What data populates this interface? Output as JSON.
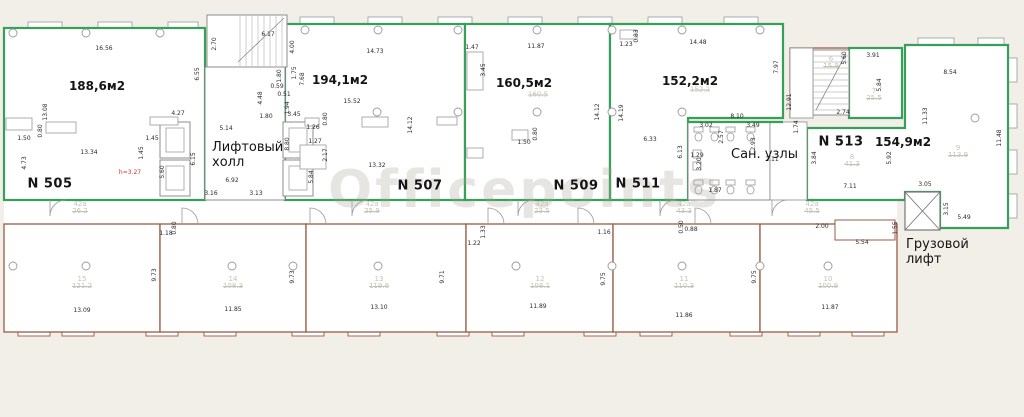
{
  "plan": {
    "watermark": "Officepoints",
    "colors": {
      "wall_green": "#36a05b",
      "wall_brown": "#9a5b45",
      "wall_gray": "#8c8c8c",
      "dim_text": "#2a2a2a",
      "ghost_text": "#c7c2b6",
      "red_dim": "#c0392b",
      "page_bg": "#f2efe8"
    },
    "rooms": [
      {
        "number": "N 505",
        "area": "188,6м2",
        "nx": 50,
        "ny": 184,
        "ax": 97,
        "ay": 86
      },
      {
        "number": "N 507",
        "area": "194,1м2",
        "nx": 420,
        "ny": 186,
        "ax": 340,
        "ay": 80
      },
      {
        "number": "N 509",
        "area": "160,5м2",
        "nx": 576,
        "ny": 186,
        "ax": 524,
        "ay": 83
      },
      {
        "number": "N 511",
        "area": "152,2м2",
        "nx": 638,
        "ny": 184,
        "ax": 690,
        "ay": 81
      },
      {
        "number": "N 513",
        "area": "154,9м2",
        "nx": 841,
        "ny": 142,
        "ax": 903,
        "ay": 142
      }
    ],
    "zones": [
      {
        "name": "lift-hall-label",
        "lines": [
          "Лифтовый",
          "холл"
        ],
        "x": 212,
        "y": 140
      },
      {
        "name": "san-units-label",
        "lines": [
          "Сан. узлы"
        ],
        "x": 731,
        "y": 147
      },
      {
        "name": "freight-lift-label",
        "lines": [
          "Грузовой",
          "лифт"
        ],
        "x": 906,
        "y": 237
      }
    ],
    "dimensions": [
      {
        "t": "16.56",
        "x": 104,
        "y": 49
      },
      {
        "t": "6.55",
        "x": 198,
        "y": 74,
        "v": 1
      },
      {
        "t": "13.08",
        "x": 46,
        "y": 112,
        "v": 1
      },
      {
        "t": "4.27",
        "x": 178,
        "y": 114
      },
      {
        "t": "1.50",
        "x": 24,
        "y": 139
      },
      {
        "t": "0.80",
        "x": 41,
        "y": 131,
        "v": 1
      },
      {
        "t": "13.34",
        "x": 89,
        "y": 153
      },
      {
        "t": "1.45",
        "x": 152,
        "y": 139
      },
      {
        "t": "1.45",
        "x": 142,
        "y": 153,
        "v": 1
      },
      {
        "t": "4.73",
        "x": 25,
        "y": 163,
        "v": 1
      },
      {
        "t": "5.60",
        "x": 163,
        "y": 172,
        "v": 1
      },
      {
        "t": "6.15",
        "x": 194,
        "y": 159,
        "v": 1
      },
      {
        "t": "h=3.27",
        "x": 130,
        "y": 173,
        "c": 1
      },
      {
        "t": "2.70",
        "x": 215,
        "y": 44,
        "v": 1
      },
      {
        "t": "6.17",
        "x": 268,
        "y": 35
      },
      {
        "t": "4.00",
        "x": 293,
        "y": 47,
        "v": 1
      },
      {
        "t": "5.14",
        "x": 226,
        "y": 129
      },
      {
        "t": "6.92",
        "x": 232,
        "y": 181
      },
      {
        "t": "3.16",
        "x": 211,
        "y": 194
      },
      {
        "t": "3.13",
        "x": 256,
        "y": 194
      },
      {
        "t": "8.80",
        "x": 288,
        "y": 144,
        "v": 1
      },
      {
        "t": "4.48",
        "x": 261,
        "y": 98,
        "v": 1
      },
      {
        "t": "1.80",
        "x": 266,
        "y": 117
      },
      {
        "t": "0.59",
        "x": 277,
        "y": 87
      },
      {
        "t": "0.51",
        "x": 284,
        "y": 95
      },
      {
        "t": "1.94",
        "x": 288,
        "y": 108,
        "v": 1
      },
      {
        "t": "1.80",
        "x": 280,
        "y": 76,
        "v": 1
      },
      {
        "t": "1.75",
        "x": 295,
        "y": 73,
        "v": 1
      },
      {
        "t": "7.68",
        "x": 303,
        "y": 79,
        "v": 1
      },
      {
        "t": "14.73",
        "x": 375,
        "y": 52
      },
      {
        "t": "15.52",
        "x": 352,
        "y": 102
      },
      {
        "t": "14.12",
        "x": 411,
        "y": 125,
        "v": 1
      },
      {
        "t": "13.32",
        "x": 377,
        "y": 166
      },
      {
        "t": "3.45",
        "x": 294,
        "y": 115
      },
      {
        "t": "1.26",
        "x": 313,
        "y": 128
      },
      {
        "t": "1.27",
        "x": 315,
        "y": 142
      },
      {
        "t": "2.17",
        "x": 326,
        "y": 155,
        "v": 1
      },
      {
        "t": "5.84",
        "x": 312,
        "y": 177,
        "v": 1
      },
      {
        "t": "0.80",
        "x": 326,
        "y": 119,
        "v": 1
      },
      {
        "t": "1.47",
        "x": 472,
        "y": 48
      },
      {
        "t": "11.87",
        "x": 536,
        "y": 47
      },
      {
        "t": "3.45",
        "x": 484,
        "y": 70,
        "v": 1
      },
      {
        "t": "1.50",
        "x": 524,
        "y": 143
      },
      {
        "t": "0.80",
        "x": 536,
        "y": 134,
        "v": 1
      },
      {
        "t": "1.23",
        "x": 626,
        "y": 45
      },
      {
        "t": "0.83",
        "x": 637,
        "y": 36,
        "v": 1
      },
      {
        "t": "14.48",
        "x": 698,
        "y": 43
      },
      {
        "t": "7.97",
        "x": 777,
        "y": 67,
        "v": 1
      },
      {
        "t": "12.91",
        "x": 790,
        "y": 102,
        "v": 1
      },
      {
        "t": "14.12",
        "x": 598,
        "y": 112,
        "v": 1
      },
      {
        "t": "14.19",
        "x": 622,
        "y": 113,
        "v": 1
      },
      {
        "t": "6.33",
        "x": 650,
        "y": 140
      },
      {
        "t": "8.10",
        "x": 737,
        "y": 117
      },
      {
        "t": "3.02",
        "x": 706,
        "y": 126
      },
      {
        "t": "3.49",
        "x": 753,
        "y": 126
      },
      {
        "t": "2.57",
        "x": 722,
        "y": 137,
        "v": 1
      },
      {
        "t": "2.93",
        "x": 754,
        "y": 144,
        "v": 1
      },
      {
        "t": "2.11",
        "x": 772,
        "y": 160
      },
      {
        "t": "6.13",
        "x": 681,
        "y": 152,
        "v": 1
      },
      {
        "t": "3.20",
        "x": 700,
        "y": 164,
        "v": 1
      },
      {
        "t": "1.29",
        "x": 697,
        "y": 156
      },
      {
        "t": "1.87",
        "x": 715,
        "y": 191
      },
      {
        "t": "1.74",
        "x": 797,
        "y": 127,
        "v": 1
      },
      {
        "t": "3.84",
        "x": 815,
        "y": 158,
        "v": 1
      },
      {
        "t": "2.74",
        "x": 843,
        "y": 113
      },
      {
        "t": "5.60",
        "x": 845,
        "y": 58,
        "v": 1
      },
      {
        "t": "3.91",
        "x": 873,
        "y": 56
      },
      {
        "t": "5.84",
        "x": 880,
        "y": 85,
        "v": 1
      },
      {
        "t": "8.54",
        "x": 950,
        "y": 73
      },
      {
        "t": "11.33",
        "x": 926,
        "y": 116,
        "v": 1
      },
      {
        "t": "11.48",
        "x": 1000,
        "y": 138,
        "v": 1
      },
      {
        "t": "3.05",
        "x": 925,
        "y": 185
      },
      {
        "t": "3.15",
        "x": 947,
        "y": 209,
        "v": 1
      },
      {
        "t": "5.49",
        "x": 964,
        "y": 218
      },
      {
        "t": "7.11",
        "x": 850,
        "y": 187
      },
      {
        "t": "5.92",
        "x": 890,
        "y": 158,
        "v": 1
      },
      {
        "t": "2.00",
        "x": 822,
        "y": 227
      },
      {
        "t": "5.54",
        "x": 862,
        "y": 243
      },
      {
        "t": "1.55",
        "x": 896,
        "y": 228,
        "v": 1
      },
      {
        "t": "1.18",
        "x": 166,
        "y": 234
      },
      {
        "t": "0.80",
        "x": 175,
        "y": 228,
        "v": 1
      },
      {
        "t": "13.09",
        "x": 82,
        "y": 311
      },
      {
        "t": "9.73",
        "x": 155,
        "y": 275,
        "v": 1
      },
      {
        "t": "11.85",
        "x": 233,
        "y": 310
      },
      {
        "t": "9.73",
        "x": 293,
        "y": 277,
        "v": 1
      },
      {
        "t": "13.10",
        "x": 379,
        "y": 308
      },
      {
        "t": "9.71",
        "x": 443,
        "y": 277,
        "v": 1
      },
      {
        "t": "1.22",
        "x": 474,
        "y": 244
      },
      {
        "t": "1.33",
        "x": 484,
        "y": 232,
        "v": 1
      },
      {
        "t": "11.89",
        "x": 538,
        "y": 307
      },
      {
        "t": "1.16",
        "x": 604,
        "y": 233
      },
      {
        "t": "0.50",
        "x": 682,
        "y": 227,
        "v": 1
      },
      {
        "t": "0.88",
        "x": 691,
        "y": 230
      },
      {
        "t": "11.86",
        "x": 684,
        "y": 316
      },
      {
        "t": "9.75",
        "x": 604,
        "y": 279,
        "v": 1
      },
      {
        "t": "9.75",
        "x": 755,
        "y": 277,
        "v": 1
      },
      {
        "t": "11.87",
        "x": 830,
        "y": 308
      }
    ],
    "cadastral": [
      {
        "id": "15",
        "area": "121.2",
        "x": 82,
        "y": 283
      },
      {
        "id": "14",
        "area": "108.3",
        "x": 233,
        "y": 283
      },
      {
        "id": "13",
        "area": "119.6",
        "x": 379,
        "y": 283
      },
      {
        "id": "12",
        "area": "108.1",
        "x": 540,
        "y": 283
      },
      {
        "id": "11",
        "area": "110.3",
        "x": 684,
        "y": 283
      },
      {
        "id": "10",
        "area": "100.9",
        "x": 828,
        "y": 283
      },
      {
        "id": "42а",
        "area": "26.2",
        "x": 80,
        "y": 208
      },
      {
        "id": "42а",
        "area": "25.9",
        "x": 372,
        "y": 208
      },
      {
        "id": "42а",
        "area": "23.5",
        "x": 542,
        "y": 208
      },
      {
        "id": "42а",
        "area": "43.3",
        "x": 684,
        "y": 208
      },
      {
        "id": "42а",
        "area": "45.5",
        "x": 812,
        "y": 208
      },
      {
        "id": "6",
        "area": "15.9",
        "x": 831,
        "y": 63
      },
      {
        "id": "7",
        "area": "25.5",
        "x": 874,
        "y": 95
      },
      {
        "id": "8",
        "area": "41.3",
        "x": 852,
        "y": 161
      },
      {
        "id": "9",
        "area": "113.9",
        "x": 958,
        "y": 152
      },
      {
        "id": "",
        "area": "160.5",
        "x": 538,
        "y": 95
      },
      {
        "id": "",
        "area": "152.2",
        "x": 700,
        "y": 90
      }
    ]
  }
}
